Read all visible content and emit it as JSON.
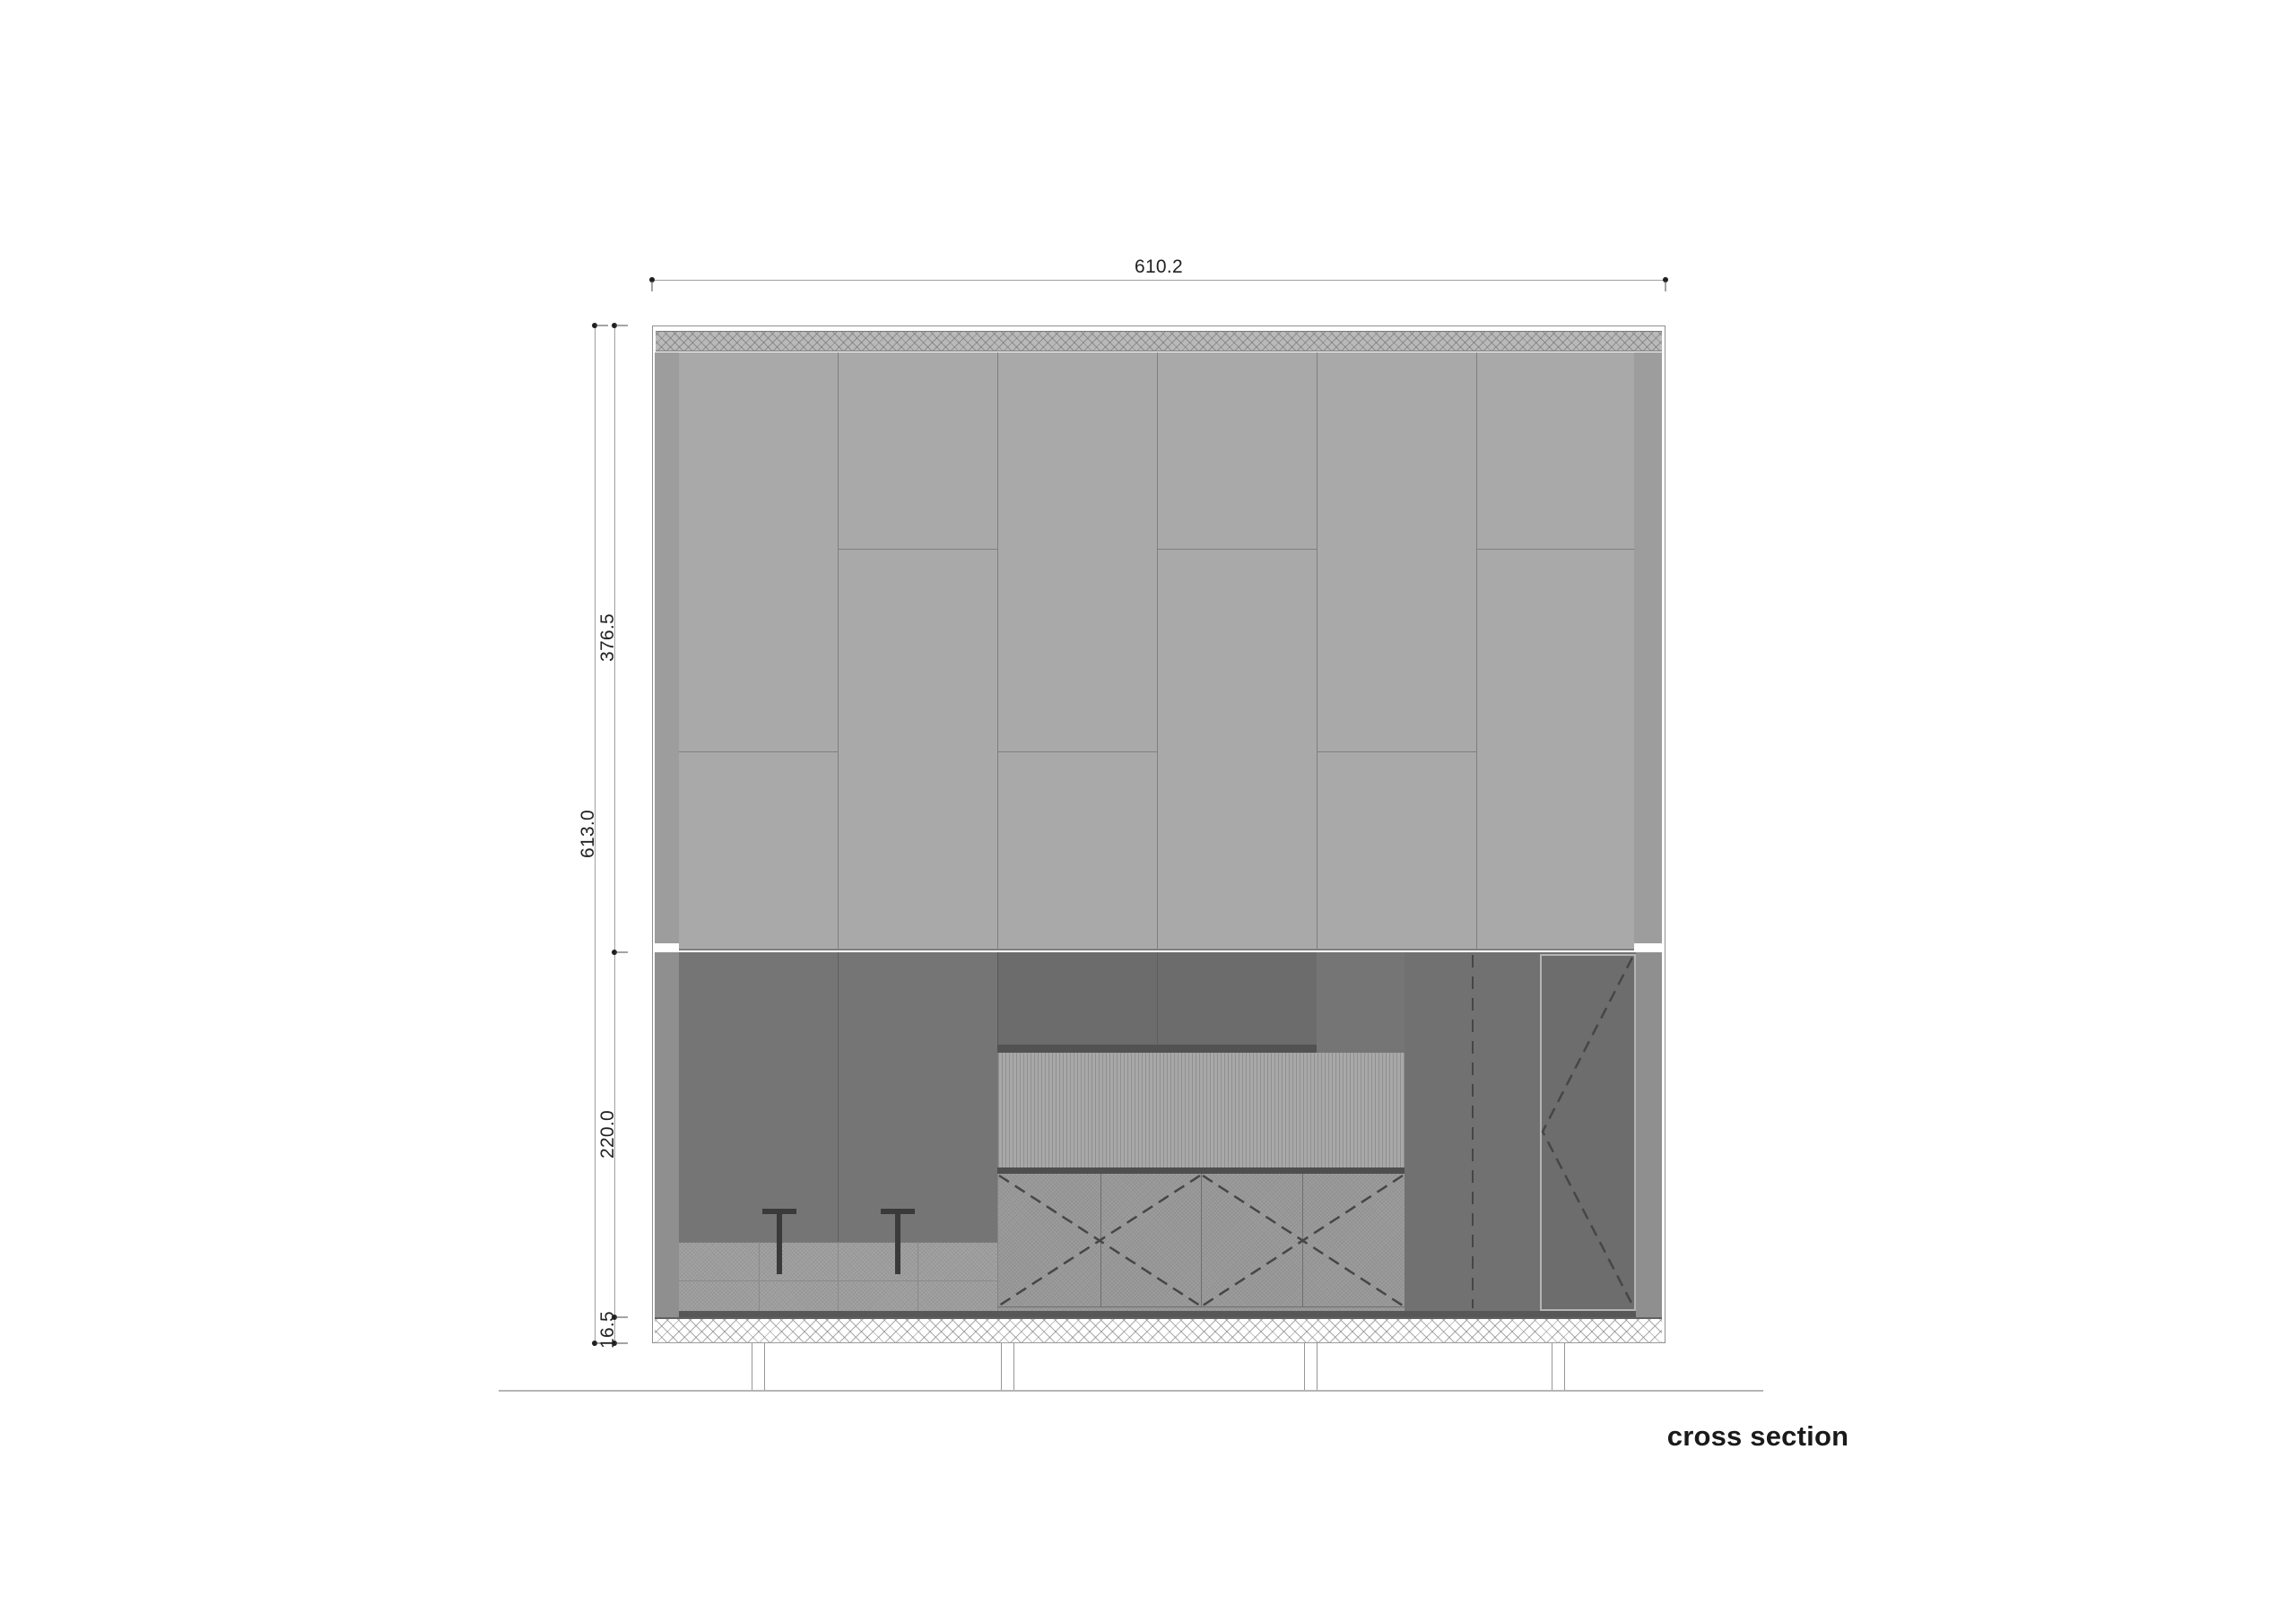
{
  "title": "cross section",
  "dimensions": {
    "overall_width": "610.2",
    "overall_height": "613.0",
    "upper_wall_height": "376.5",
    "interior_height": "220.0",
    "floor_slab_thickness": "16.5"
  },
  "colors": {
    "sheet_bg": "#ffffff",
    "frame_line": "#8f8f8f",
    "roof_fill": "#b9b9b9",
    "roof_line": "#7a7a7a",
    "panel_fill": "#a9a9a9",
    "panel_line": "#7f7f7f",
    "strip_upper": "#9d9d9d",
    "strip_lower": "#8f8f8f",
    "wall_fill": "#757575",
    "wall_joint": "#5e5e5e",
    "bench_fill": "#a3a3a3",
    "cabinet_upper_fill": "#6c6c6c",
    "cabinet_shadow": "#525252",
    "backsplash_fill": "#a8a8a8",
    "countertop": "#4e4e4e",
    "cabinet_front_fill": "#9d9d9d",
    "right_wall_fill": "#717171",
    "door_fill": "#6d6d6d",
    "door_frame": "#b4b4b4",
    "base_strip": "#575757",
    "stool": "#3a3a3a",
    "dash_stroke": "#464646",
    "dim_line": "#a0a0a0",
    "dim_mark": "#1f1f1f",
    "dim_text": "#222222",
    "ground_line": "#b5b5b5",
    "title_text": "#1a1a1a"
  }
}
